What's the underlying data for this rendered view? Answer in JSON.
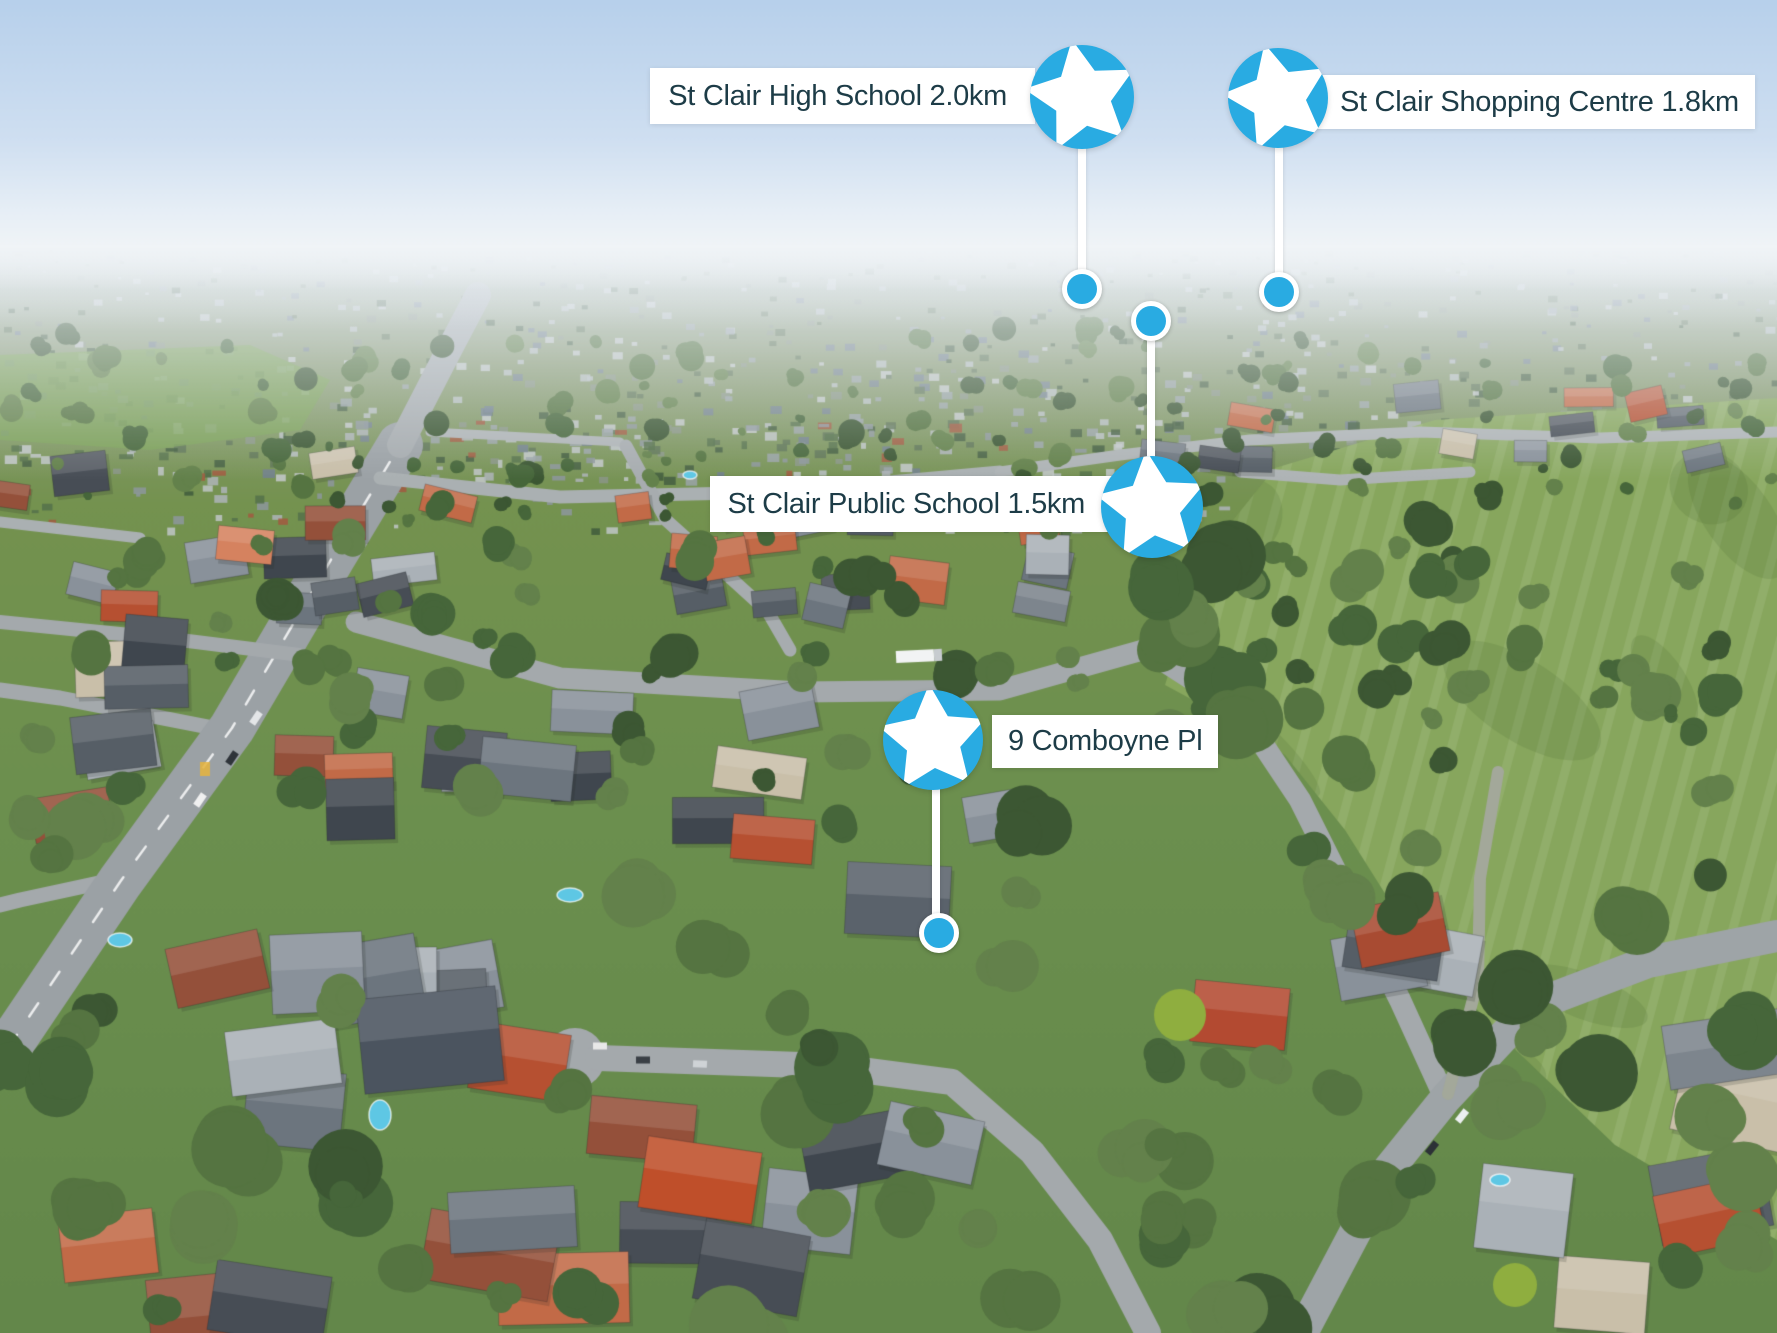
{
  "annotations": {
    "high_school": {
      "label": "St Clair High School 2.0km",
      "icon": "star-icon"
    },
    "shopping_centre": {
      "label": "St Clair Shopping Centre 1.8km",
      "icon": "star-icon"
    },
    "public_school": {
      "label": "St Clair Public School 1.5km",
      "icon": "star-icon"
    },
    "property": {
      "label": "9 Comboyne Pl",
      "icon": "star-icon"
    }
  },
  "colors": {
    "marker_blue": "#29abe2",
    "label_background": "#ffffff",
    "label_text": "#1d3c47",
    "connector": "#ffffff"
  }
}
